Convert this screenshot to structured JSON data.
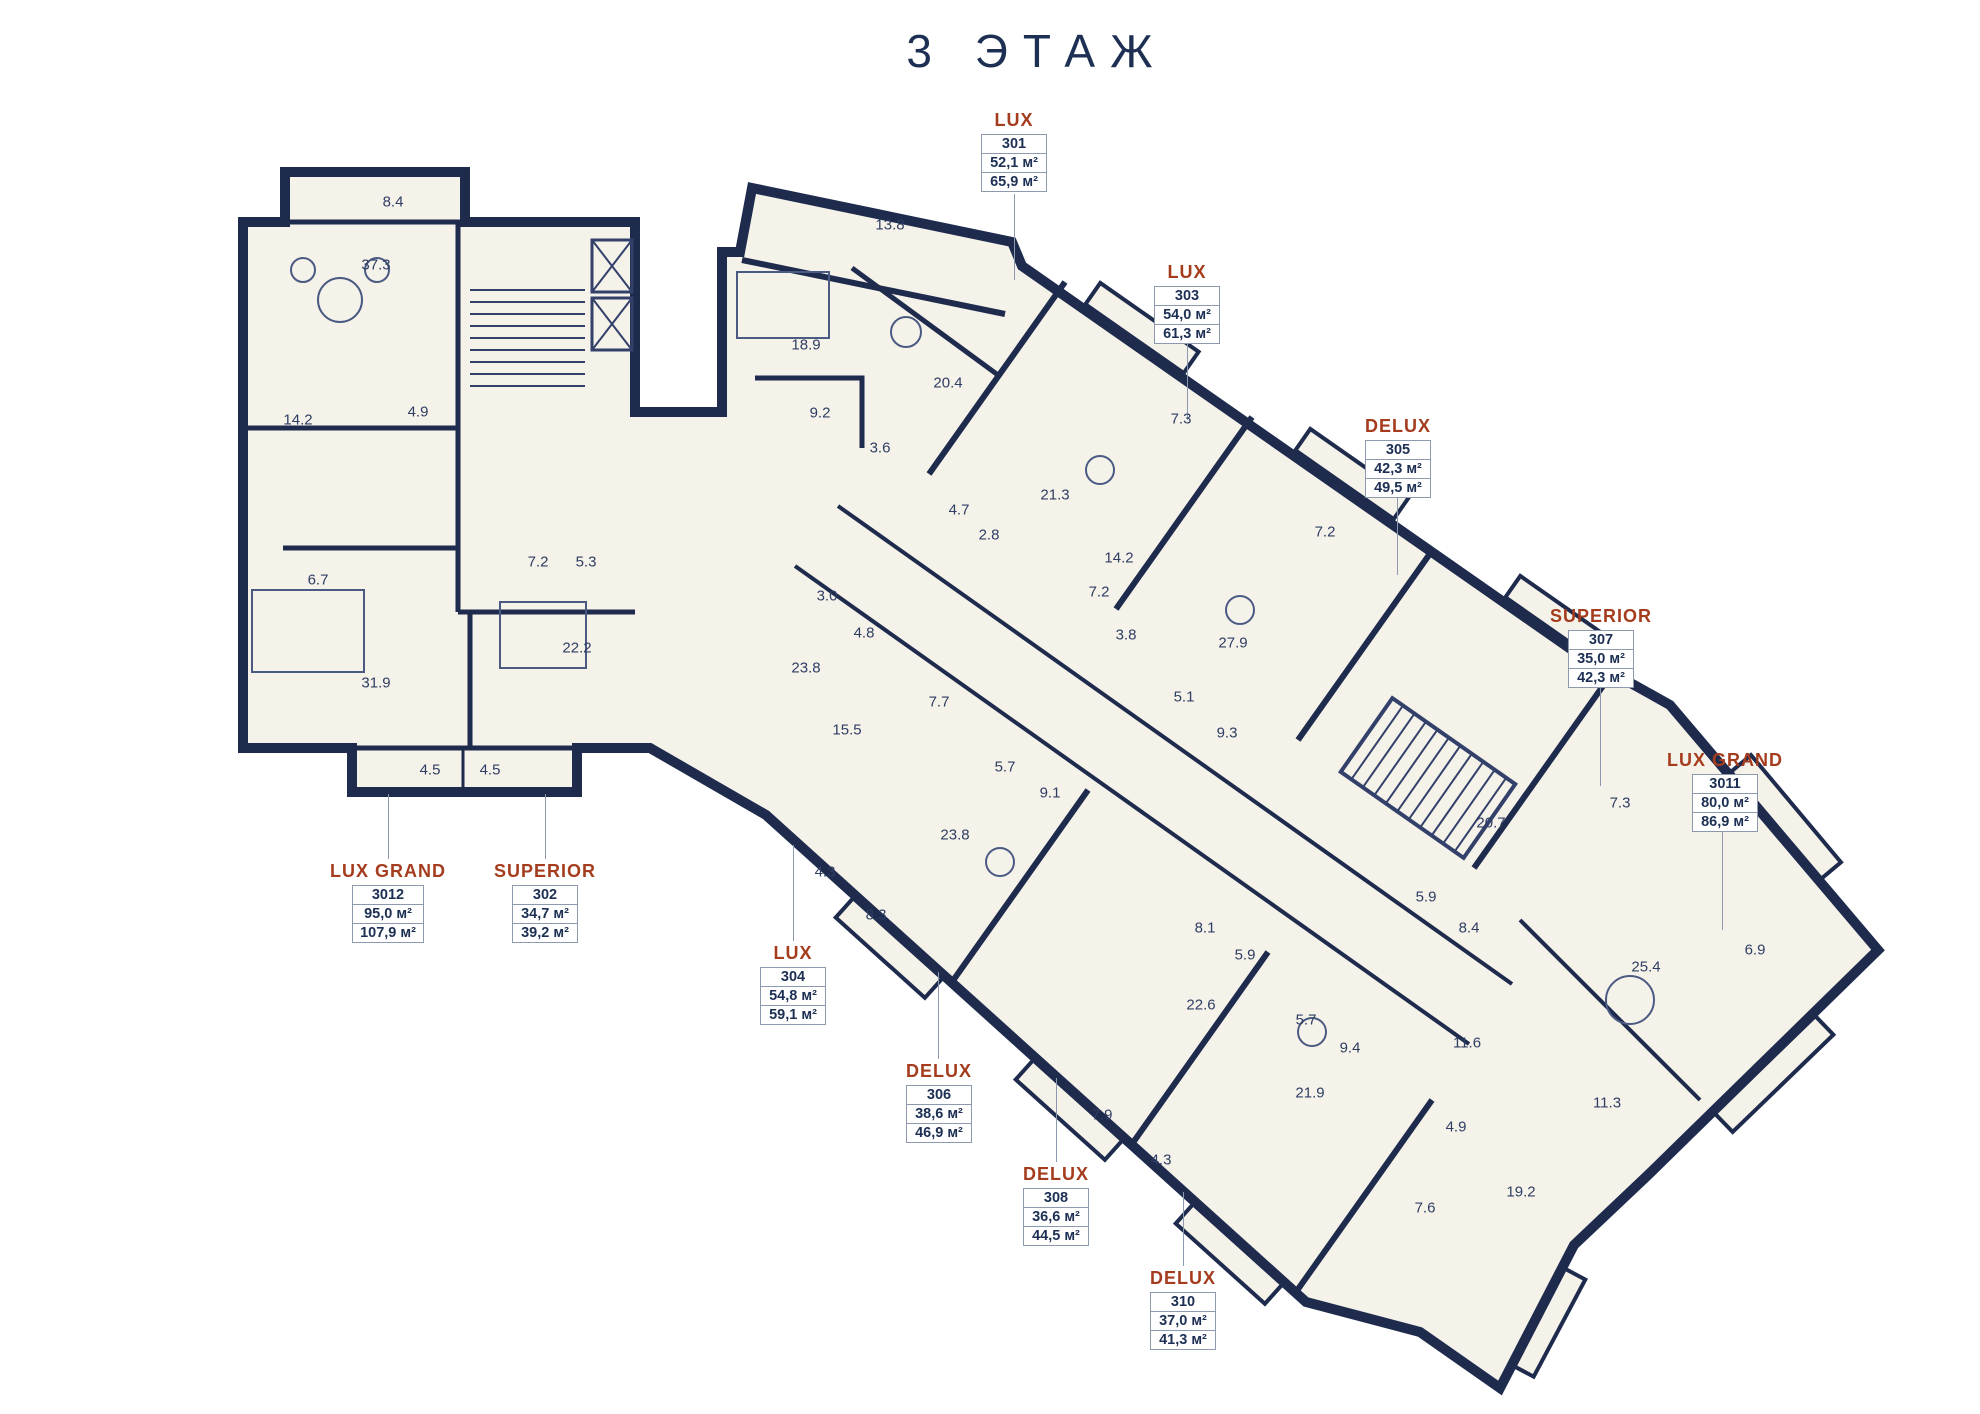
{
  "title": "3 ЭТАЖ",
  "floor_number": "3",
  "area_unit": "м²",
  "colors": {
    "navy": "#1d3054",
    "wall": "#1e2b4d",
    "rust": "#a53c1d",
    "floor": "#f5f2ea",
    "line": "#8d99ae",
    "roomtext": "#2e3d63"
  },
  "units": [
    {
      "type": "LUX",
      "number": "301",
      "area_living": "52,1 м²",
      "area_total": "65,9 м²",
      "x": 1014,
      "y": 110,
      "leader": {
        "x": 1014,
        "y1": 194,
        "y2": 280
      }
    },
    {
      "type": "LUX",
      "number": "303",
      "area_living": "54,0 м²",
      "area_total": "61,3 м²",
      "x": 1187,
      "y": 262,
      "leader": {
        "x": 1187,
        "y1": 343,
        "y2": 420
      }
    },
    {
      "type": "DELUX",
      "number": "305",
      "area_living": "42,3 м²",
      "area_total": "49,5 м²",
      "x": 1398,
      "y": 416,
      "leader": {
        "x": 1397,
        "y1": 492,
        "y2": 575
      }
    },
    {
      "type": "SUPERIOR",
      "number": "307",
      "area_living": "35,0 м²",
      "area_total": "42,3 м²",
      "x": 1601,
      "y": 606,
      "leader": {
        "x": 1600,
        "y1": 684,
        "y2": 786
      }
    },
    {
      "type": "LUX GRAND",
      "number": "3011",
      "area_living": "80,0 м²",
      "area_total": "86,9 м²",
      "x": 1725,
      "y": 750,
      "leader": {
        "x": 1722,
        "y1": 828,
        "y2": 930
      }
    },
    {
      "type": "LUX GRAND",
      "number": "3012",
      "area_living": "95,0 м²",
      "area_total": "107,9 м²",
      "x": 388,
      "y": 861,
      "leader": {
        "x": 388,
        "y1": 794,
        "y2": 859
      }
    },
    {
      "type": "SUPERIOR",
      "number": "302",
      "area_living": "34,7 м²",
      "area_total": "39,2 м²",
      "x": 545,
      "y": 861,
      "leader": {
        "x": 545,
        "y1": 794,
        "y2": 859
      }
    },
    {
      "type": "LUX",
      "number": "304",
      "area_living": "54,8 м²",
      "area_total": "59,1 м²",
      "x": 793,
      "y": 943,
      "leader": {
        "x": 793,
        "y1": 845,
        "y2": 941
      }
    },
    {
      "type": "DELUX",
      "number": "306",
      "area_living": "38,6 м²",
      "area_total": "46,9 м²",
      "x": 939,
      "y": 1061,
      "leader": {
        "x": 938,
        "y1": 972,
        "y2": 1059
      }
    },
    {
      "type": "DELUX",
      "number": "308",
      "area_living": "36,6 м²",
      "area_total": "44,5 м²",
      "x": 1056,
      "y": 1164,
      "leader": {
        "x": 1056,
        "y1": 1078,
        "y2": 1162
      }
    },
    {
      "type": "DELUX",
      "number": "310",
      "area_living": "37,0 м²",
      "area_total": "41,3 м²",
      "x": 1183,
      "y": 1268,
      "leader": {
        "x": 1183,
        "y1": 1192,
        "y2": 1266
      }
    }
  ],
  "rooms": [
    {
      "v": "8.4",
      "x": 393,
      "y": 202
    },
    {
      "v": "37.3",
      "x": 376,
      "y": 265
    },
    {
      "v": "14.2",
      "x": 298,
      "y": 420
    },
    {
      "v": "4.9",
      "x": 418,
      "y": 412
    },
    {
      "v": "6.7",
      "x": 318,
      "y": 580
    },
    {
      "v": "31.9",
      "x": 376,
      "y": 683
    },
    {
      "v": "7.2",
      "x": 538,
      "y": 562
    },
    {
      "v": "5.3",
      "x": 586,
      "y": 562
    },
    {
      "v": "22.2",
      "x": 577,
      "y": 648
    },
    {
      "v": "4.5",
      "x": 430,
      "y": 770
    },
    {
      "v": "4.5",
      "x": 490,
      "y": 770
    },
    {
      "v": "13.8",
      "x": 890,
      "y": 225
    },
    {
      "v": "18.9",
      "x": 806,
      "y": 345
    },
    {
      "v": "20.4",
      "x": 948,
      "y": 383
    },
    {
      "v": "9.2",
      "x": 820,
      "y": 413
    },
    {
      "v": "3.6",
      "x": 880,
      "y": 448
    },
    {
      "v": "21.3",
      "x": 1055,
      "y": 495
    },
    {
      "v": "4.7",
      "x": 959,
      "y": 510
    },
    {
      "v": "2.8",
      "x": 989,
      "y": 535
    },
    {
      "v": "7.3",
      "x": 1181,
      "y": 419
    },
    {
      "v": "14.2",
      "x": 1119,
      "y": 558
    },
    {
      "v": "7.2",
      "x": 1099,
      "y": 592
    },
    {
      "v": "3.8",
      "x": 1126,
      "y": 635
    },
    {
      "v": "7.2",
      "x": 1325,
      "y": 532
    },
    {
      "v": "27.9",
      "x": 1233,
      "y": 643
    },
    {
      "v": "5.1",
      "x": 1184,
      "y": 697
    },
    {
      "v": "9.3",
      "x": 1227,
      "y": 733
    },
    {
      "v": "3.0",
      "x": 827,
      "y": 596
    },
    {
      "v": "4.8",
      "x": 864,
      "y": 633
    },
    {
      "v": "23.8",
      "x": 806,
      "y": 668
    },
    {
      "v": "7.7",
      "x": 939,
      "y": 702
    },
    {
      "v": "15.5",
      "x": 847,
      "y": 730
    },
    {
      "v": "5.7",
      "x": 1005,
      "y": 767
    },
    {
      "v": "9.1",
      "x": 1050,
      "y": 793
    },
    {
      "v": "23.8",
      "x": 955,
      "y": 835
    },
    {
      "v": "4.3",
      "x": 825,
      "y": 872
    },
    {
      "v": "8.3",
      "x": 876,
      "y": 915
    },
    {
      "v": "8.1",
      "x": 1205,
      "y": 928
    },
    {
      "v": "5.9",
      "x": 1245,
      "y": 955
    },
    {
      "v": "22.6",
      "x": 1201,
      "y": 1005
    },
    {
      "v": "5.7",
      "x": 1306,
      "y": 1020
    },
    {
      "v": "9.4",
      "x": 1350,
      "y": 1048
    },
    {
      "v": "21.9",
      "x": 1310,
      "y": 1093
    },
    {
      "v": "7.9",
      "x": 1102,
      "y": 1115
    },
    {
      "v": "4.3",
      "x": 1161,
      "y": 1160
    },
    {
      "v": "4.9",
      "x": 1456,
      "y": 1127
    },
    {
      "v": "11.6",
      "x": 1467,
      "y": 1043
    },
    {
      "v": "5.9",
      "x": 1426,
      "y": 897
    },
    {
      "v": "8.4",
      "x": 1469,
      "y": 928
    },
    {
      "v": "20.7",
      "x": 1491,
      "y": 823
    },
    {
      "v": "7.3",
      "x": 1620,
      "y": 803
    },
    {
      "v": "25.4",
      "x": 1646,
      "y": 967
    },
    {
      "v": "6.9",
      "x": 1755,
      "y": 950
    },
    {
      "v": "11.3",
      "x": 1607,
      "y": 1103
    },
    {
      "v": "7.6",
      "x": 1425,
      "y": 1208
    },
    {
      "v": "19.2",
      "x": 1521,
      "y": 1192
    }
  ]
}
